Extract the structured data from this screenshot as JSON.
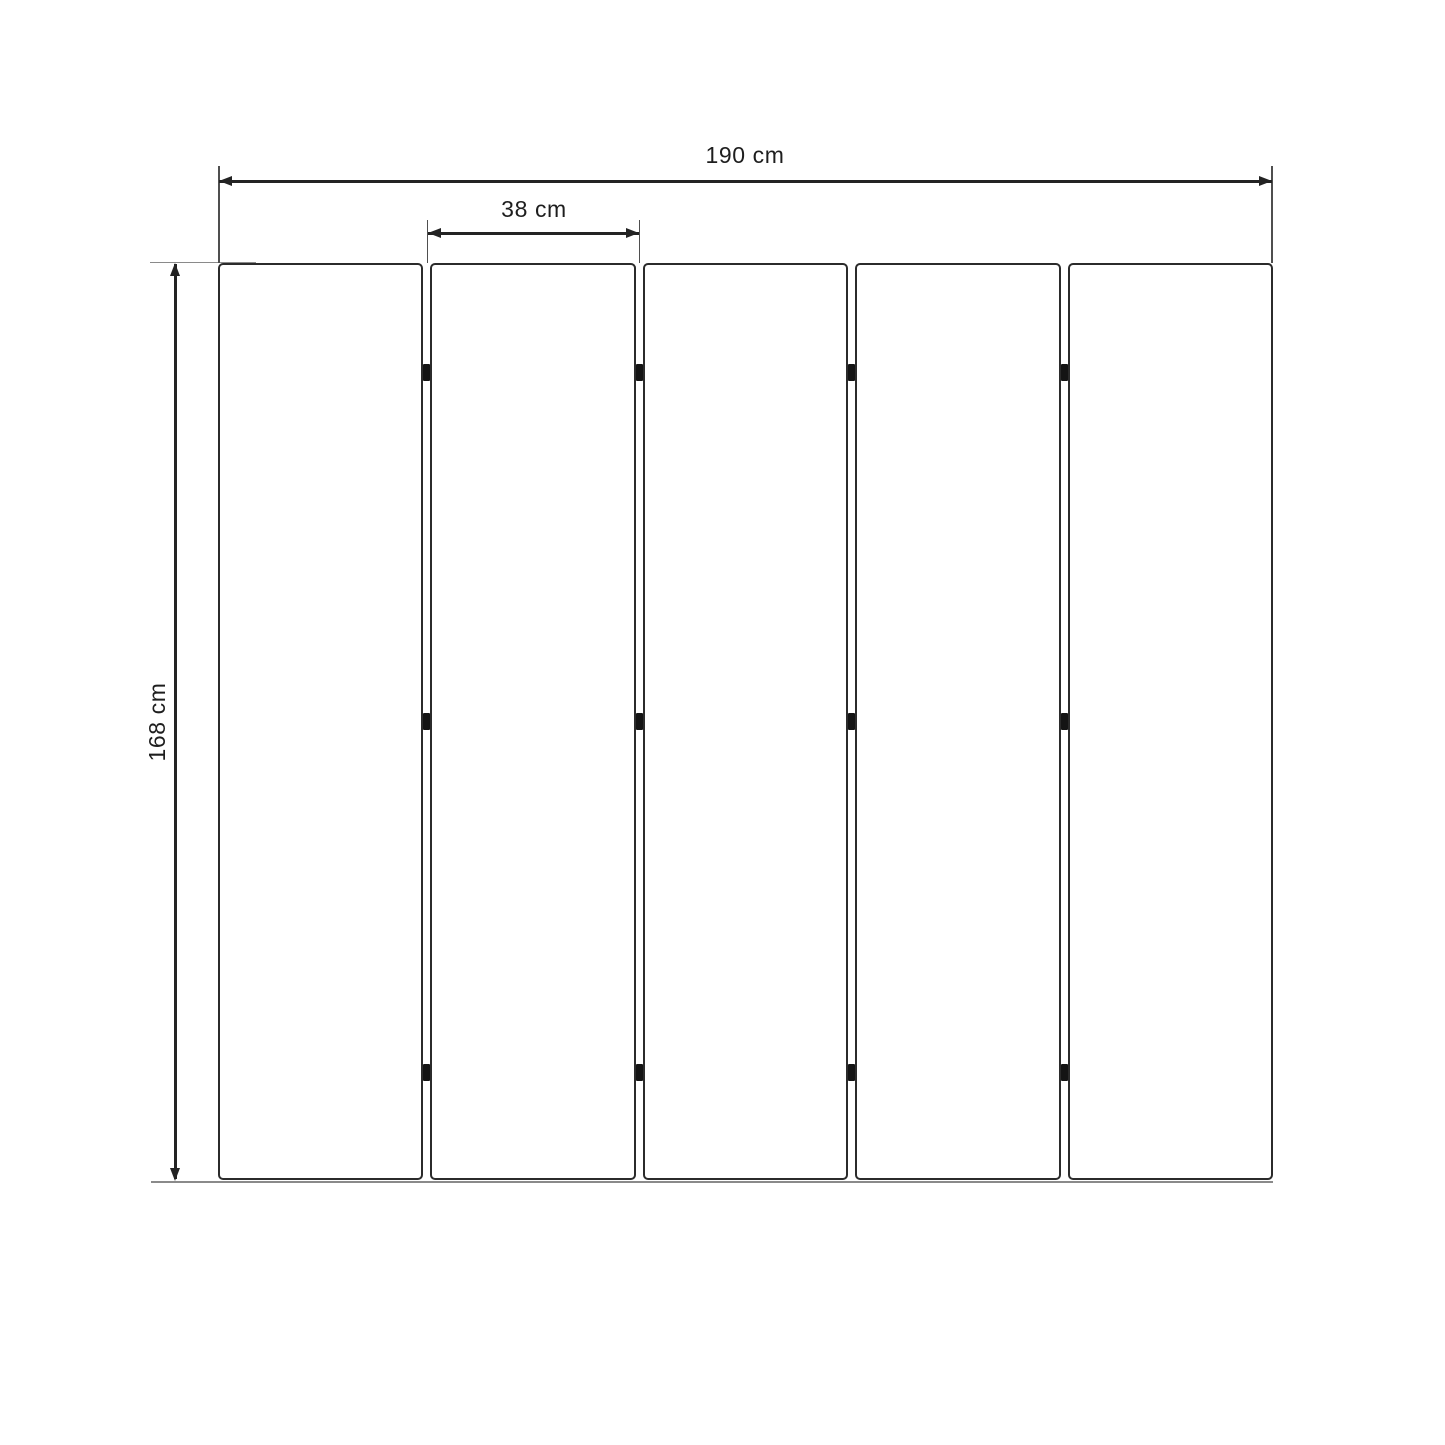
{
  "diagram": {
    "type": "dimension-drawing",
    "dimensions": {
      "total_width": {
        "value": 190,
        "unit": "cm",
        "label": "190 cm"
      },
      "panel_width": {
        "value": 38,
        "unit": "cm",
        "label": "38 cm"
      },
      "height": {
        "value": 168,
        "unit": "cm",
        "label": "168 cm"
      }
    },
    "panels": {
      "count": 5,
      "gap_count": 4,
      "hinges_per_gap": 3
    },
    "colors": {
      "background": "#ffffff",
      "line": "#232323",
      "panel_border": "#2b2b2b",
      "hinge": "#141414",
      "extension_line": "#8a8a8a"
    }
  }
}
